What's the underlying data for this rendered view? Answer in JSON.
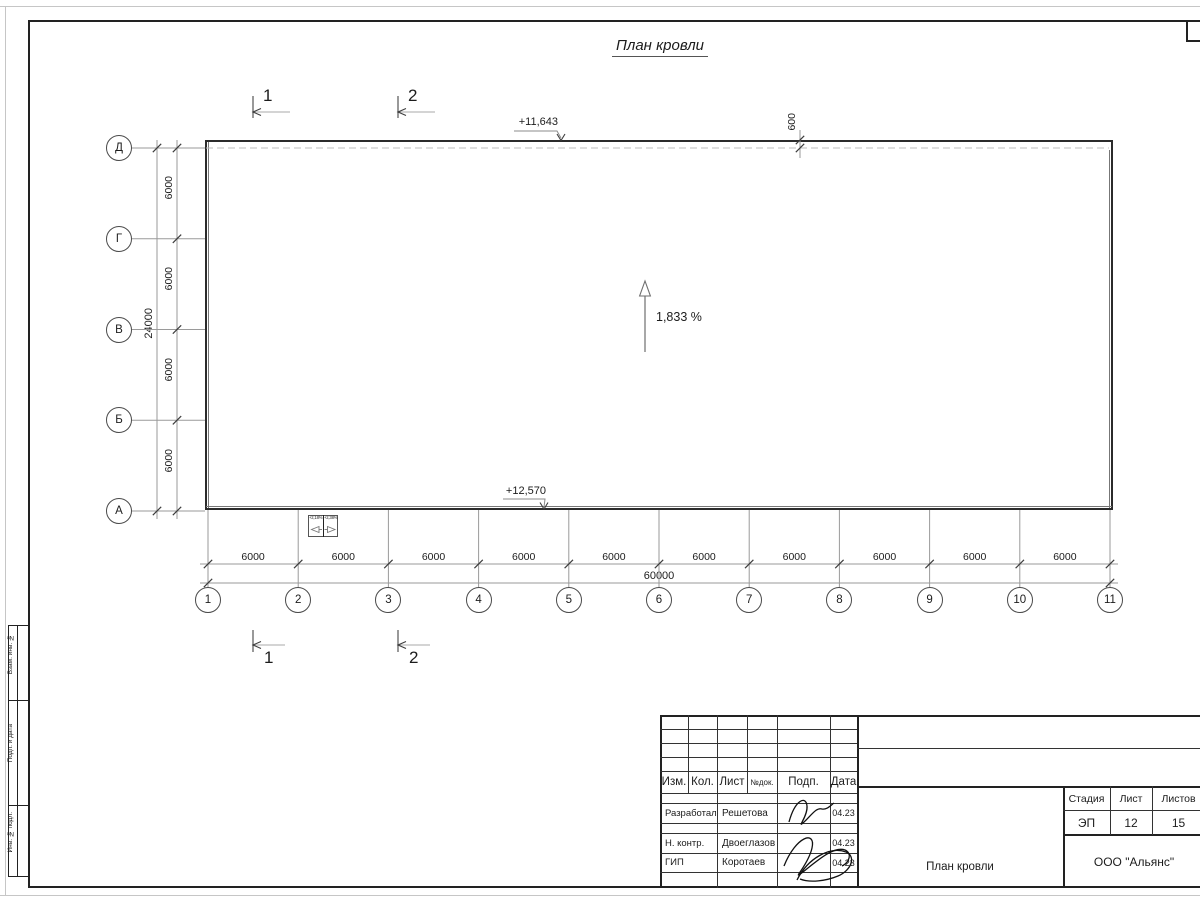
{
  "sheet": {
    "title": "План кровли"
  },
  "grid": {
    "col_axes": [
      "1",
      "2",
      "3",
      "4",
      "5",
      "6",
      "7",
      "8",
      "9",
      "10",
      "11"
    ],
    "row_axes": [
      "Д",
      "Г",
      "В",
      "Б",
      "А"
    ],
    "col_dim": "6000",
    "col_total": "60000",
    "row_dim": "6000",
    "row_total": "24000",
    "overhang_dim": "600"
  },
  "marks": {
    "elevation_top": "+11,643",
    "elevation_bottom": "+12,570",
    "slope": "1,833 %",
    "sections": [
      "1",
      "2"
    ],
    "funnels": [
      "+2,18%",
      "+2,38%"
    ]
  },
  "frame_strip": [
    "Взам. инв. №",
    "Подп. и дата",
    "Инв. № подл."
  ],
  "title_block": {
    "columns": [
      "Изм.",
      "Кол.",
      "Лист",
      "№док.",
      "Подп.",
      "Дата"
    ],
    "people": [
      {
        "role": "Разработал",
        "name": "Решетова",
        "date": "04.23"
      },
      {
        "role": "Н. контр.",
        "name": "Двоеглазов",
        "date": "04.23"
      },
      {
        "role": "ГИП",
        "name": "Коротаев",
        "date": "04.23"
      }
    ],
    "stage_label": "Стадия",
    "sheet_label": "Лист",
    "sheets_label": "Листов",
    "stage": "ЭП",
    "sheet_no": "12",
    "sheets_total": "15",
    "doc_name": "План кровли",
    "company": "ООО \"Альянс\""
  }
}
